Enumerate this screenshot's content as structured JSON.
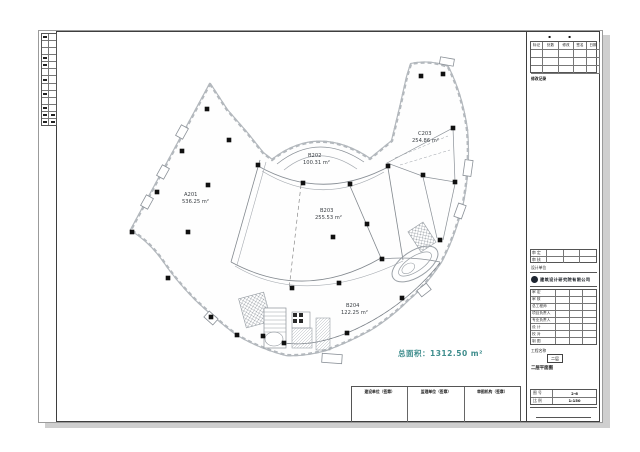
{
  "page": {
    "bg": "#ffffff"
  },
  "plan": {
    "rooms": [
      {
        "id": "A201",
        "area": "536.25 m²"
      },
      {
        "id": "B202",
        "area": "100.31 m²"
      },
      {
        "id": "B203",
        "area": "255.53 m²"
      },
      {
        "id": "B204",
        "area": "122.25 m²"
      },
      {
        "id": "C203",
        "area": "254.86 m²"
      }
    ],
    "total_label": "总面积：1312.50 m²",
    "total_color": "#3f8d8d",
    "columns": [
      [
        207,
        109
      ],
      [
        229,
        140
      ],
      [
        182,
        151
      ],
      [
        157,
        192
      ],
      [
        208,
        185
      ],
      [
        132,
        232
      ],
      [
        188,
        232
      ],
      [
        168,
        278
      ],
      [
        211,
        317
      ],
      [
        258,
        165
      ],
      [
        303,
        183
      ],
      [
        350,
        184
      ],
      [
        388,
        166
      ],
      [
        423,
        175
      ],
      [
        455,
        182
      ],
      [
        421,
        76
      ],
      [
        443,
        74
      ],
      [
        453,
        128
      ],
      [
        440,
        240
      ],
      [
        382,
        259
      ],
      [
        367,
        224
      ],
      [
        333,
        237
      ],
      [
        292,
        288
      ],
      [
        339,
        283
      ],
      [
        347,
        333
      ],
      [
        402,
        298
      ],
      [
        284,
        343
      ],
      [
        263,
        336
      ],
      [
        237,
        335
      ]
    ]
  },
  "left_strip": {
    "rows": 13,
    "marked": [
      0,
      3,
      4,
      6,
      8,
      10,
      11,
      12
    ]
  },
  "titleblock": {
    "corner_marks": "▪ ▪",
    "revision": {
      "headers": [
        "标记",
        "处数",
        "修改",
        "签名",
        "日期"
      ],
      "rows": 3,
      "note": "修改记录"
    },
    "sign_rows": [
      "审 定",
      "审 核"
    ],
    "unit_label": "设计单位",
    "company": "建筑设计研究院有限公司",
    "personnel": [
      "审 定",
      "审 核",
      "总工程师",
      "项目负责人",
      "专业负责人",
      "设 计",
      "校 对",
      "制 图"
    ],
    "project_label": "工程名称",
    "floor_tag": "二层",
    "drawing_name": "二层平面图",
    "meta_rows": [
      {
        "label": "图 号",
        "value": "2-6"
      },
      {
        "label": "比 例",
        "value": "1:150"
      }
    ]
  },
  "stamps": {
    "cells": [
      "建设单位（签章）",
      "监理单位（签章）",
      "审图机构（签章）"
    ]
  }
}
